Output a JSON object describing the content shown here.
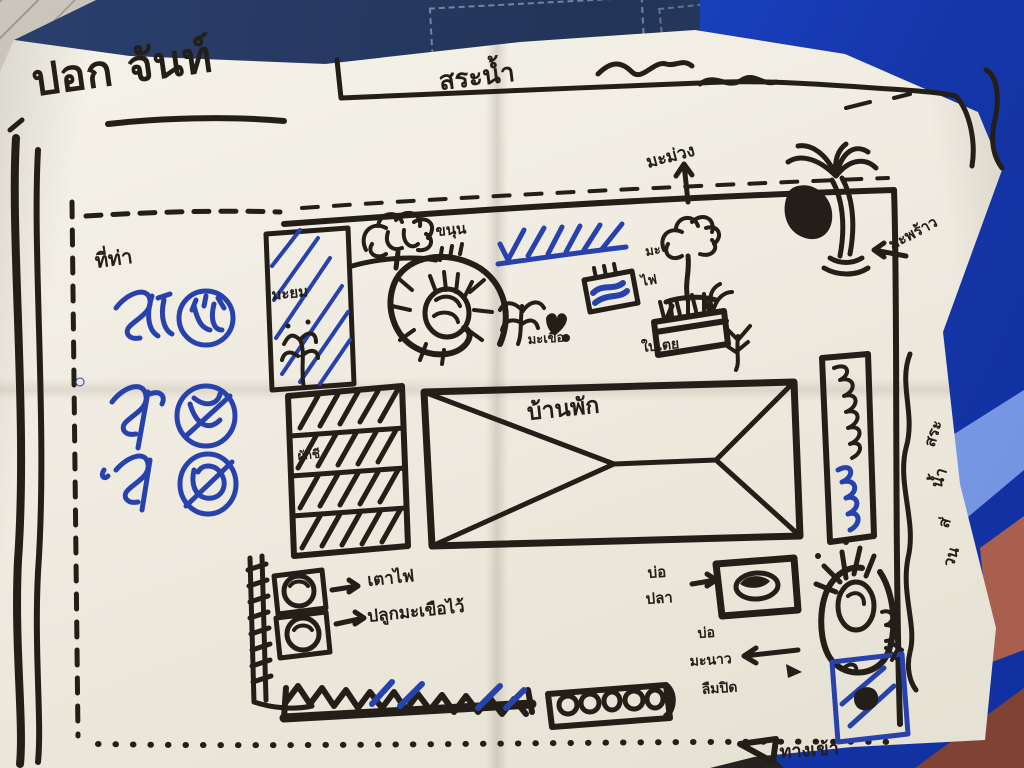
{
  "colors": {
    "ink": "#241e18",
    "pen_blue": "#2742ad",
    "paper": "#f1ede3",
    "plastic_blue": "#1d47cf",
    "tile_gray": "#c3bfb5"
  },
  "title": "ปอก จันท์",
  "top": {
    "road_label": "สระน้ำ",
    "mango": "มะม่วง",
    "coconut": "มะพร้าว"
  },
  "left": {
    "note": "ที่ท่า"
  },
  "garden": {
    "bed_note": "มะยม",
    "jackfruit": "ขนุน",
    "mafai": [
      "มะ",
      "ไฟ"
    ],
    "eggplant": "มะเขือ",
    "pandan": "ใบเตย",
    "veg_rows": "ผักชี",
    "house": "บ้านพัก"
  },
  "bottom": {
    "stove": "เตาไฟ",
    "planting_note": "ปลูกมะเขือไว้",
    "fish_pond": [
      "บ่อ",
      "ปลา"
    ],
    "lime_pond": [
      "บ่อ",
      "มะนาว",
      "ลืมปิด"
    ],
    "entrance": "ทางเข้า"
  },
  "right": {
    "pond_vertical": [
      "สระ",
      "น้ำ",
      "ส่",
      "วน"
    ]
  }
}
